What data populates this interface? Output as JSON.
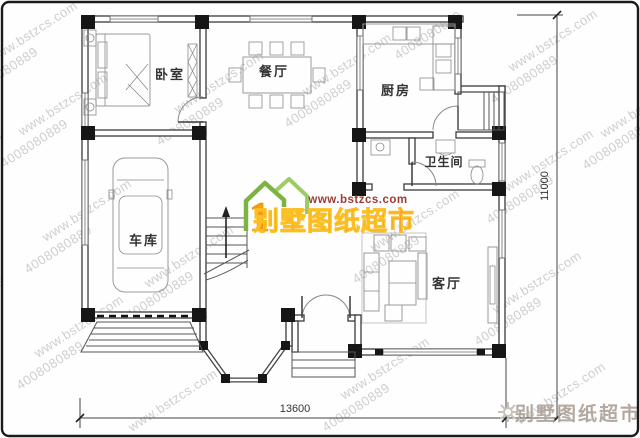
{
  "rooms": {
    "bedroom": "卧室",
    "dining": "餐厅",
    "kitchen": "厨房",
    "bathroom": "卫生间",
    "garage": "车库",
    "living": "客厅"
  },
  "dimensions": {
    "width": "13600",
    "height": "11000"
  },
  "logo": {
    "site": "www.bstzcs.com",
    "brand": "别墅图纸超市",
    "numeral": "1"
  },
  "corner": {
    "brand": "别墅图纸超市"
  },
  "watermark": {
    "site": "www.bstzcs.com",
    "phone": "4008080889",
    "tel": "电话"
  },
  "colors": {
    "logo_green": "#7cb342",
    "logo_red": "#e3342c",
    "logo_orange": "#f59e0b",
    "logo_url_red": "#9c3b34",
    "watermark_gray": "#c6c6c6",
    "corner_gray": "#b3a89f"
  }
}
